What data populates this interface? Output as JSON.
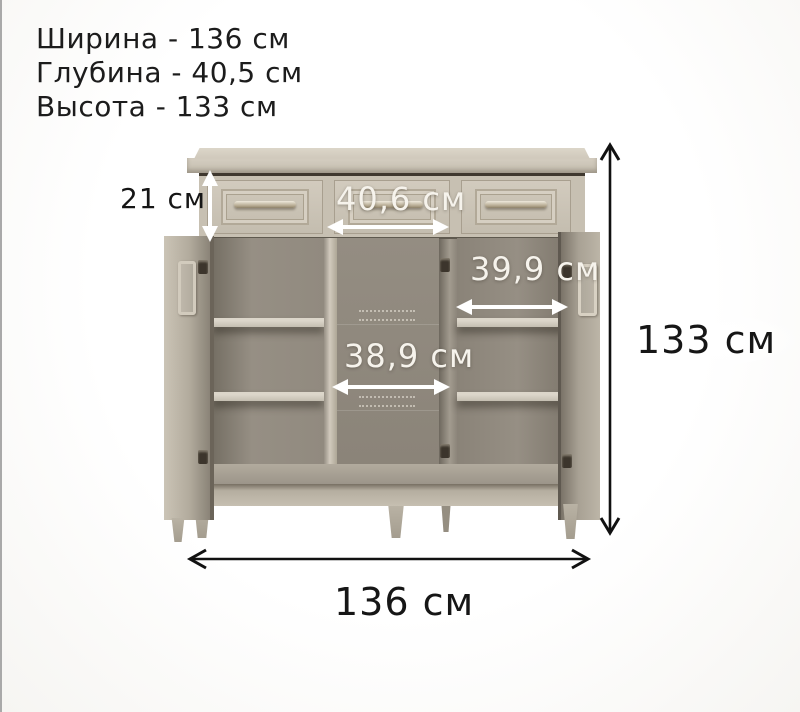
{
  "specs": {
    "width_line": "Ширина - 136 см",
    "depth_line": "Глубина - 40,5 см",
    "height_line": "Высота -  133 см"
  },
  "annotations": {
    "drawer_height": "21 см",
    "middle_drawer_width": "40,6 см",
    "right_section_width": "39,9 см",
    "middle_section_width": "38,9 см",
    "overall_height": "133 см",
    "overall_width": "136 см"
  },
  "object": {
    "type": "chest-sideboard-with-3-drawers-and-3-doors",
    "drawer_count": 3,
    "door_count": 3,
    "shelves_per_side_section": 2
  },
  "colors": {
    "background": "#fbfaf8",
    "cabinet_front": "#c7c0b2",
    "cabinet_cornice": "#d5cec1",
    "cabinet_interior": "#8e887d",
    "shelf_edge": "#d0c9bc",
    "dark_text": "#161616",
    "light_text": "#f6f3ec",
    "arrow_white": "#ffffff",
    "arrow_black": "#111111"
  }
}
